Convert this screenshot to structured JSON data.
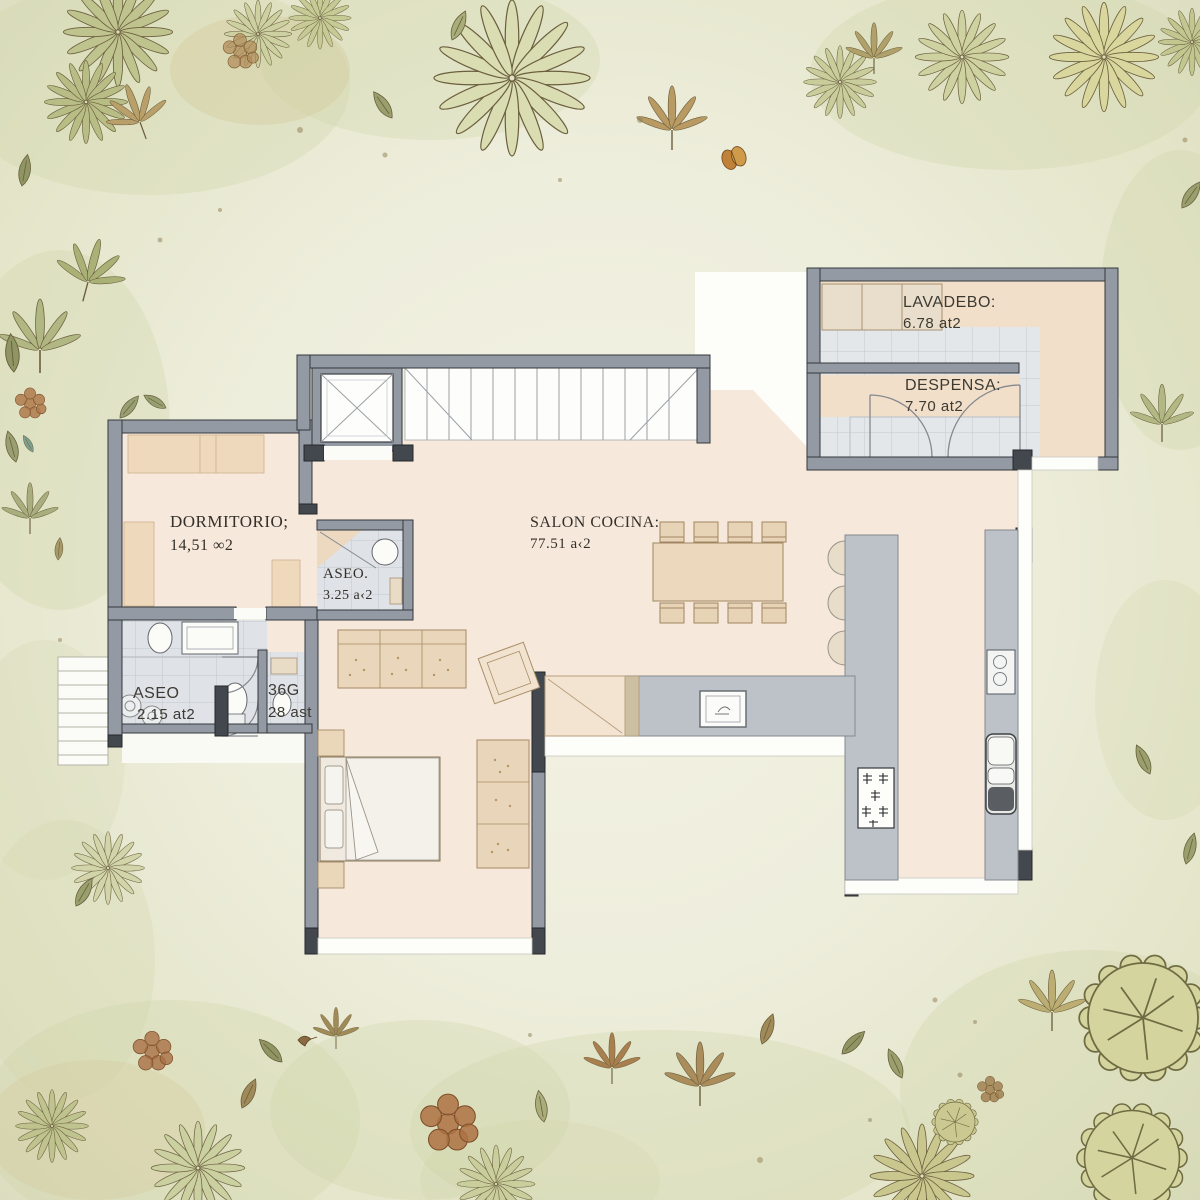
{
  "plan_title": "floor-plan",
  "rooms": {
    "lavadero": {
      "label": "LAVADEBO:",
      "area": "6.78 at2"
    },
    "despensa": {
      "label": "DESPENSA:",
      "area": "7.70 at2"
    },
    "dormitorio": {
      "label": "DORMITORIO;",
      "area": "14,51 ∞2"
    },
    "aseo_small": {
      "label": "ASEO.",
      "area": "3.25 a‹2"
    },
    "salon": {
      "label": "SALON COCINA:",
      "area": "77.51 a‹2"
    },
    "aseo": {
      "label": "ASEO",
      "area": "2.15 at2"
    },
    "room_36g": {
      "label": "36G",
      "area": "28 ast"
    }
  },
  "colors": {
    "background": "#eeeedd",
    "watercolor_wash": "#ced3a6",
    "wall": "#939aa3",
    "wall_dark": "#43484e",
    "floor_peach": "#f6e8da",
    "floor_tile": "#e4e7ea",
    "counter_gray": "#bcc2c7",
    "furniture_tan": "#ead7bb",
    "band_peach": "#eed9bd",
    "label_text": "#3d3a33"
  }
}
